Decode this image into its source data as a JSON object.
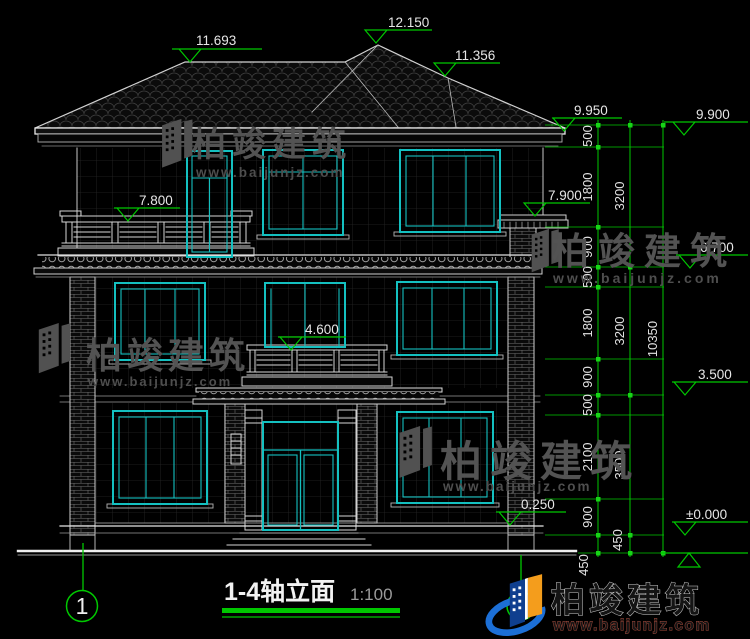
{
  "title": {
    "text": "1-4轴立面",
    "scale": "1:100"
  },
  "axis_bubbles": {
    "left": "1",
    "right": "4"
  },
  "elevation_markers": {
    "ridge_left": "11.693",
    "ridge_main": "12.150",
    "ridge_right": "11.356",
    "eave_left": "9.950",
    "grid_right_top": "9.900",
    "canopy_right": "7.900",
    "balcony_rail_top": "7.800",
    "floor3": "6.700",
    "mid_balcony": "4.600",
    "floor2": "3.500",
    "plinth": "0.250",
    "ground": "±0.000"
  },
  "dimension_chains": {
    "fine": [
      "500",
      "1800",
      "900",
      "500",
      "1800",
      "900",
      "500",
      "2100",
      "900",
      "450"
    ],
    "floors": [
      "3200",
      "3200",
      "3500",
      "450"
    ],
    "total": "10350"
  },
  "watermark": {
    "brand": "柏竣建筑",
    "website": "www.baijunjz.com"
  },
  "footer_logo": {
    "brand": "柏竣建筑",
    "website": "www.baijunjz.com"
  },
  "colors": {
    "background": "#000000",
    "line": "#c9c9c9",
    "window_accent": "#14c0c0",
    "dimension_green": "#00c800",
    "watermark_gray": "#515151"
  }
}
